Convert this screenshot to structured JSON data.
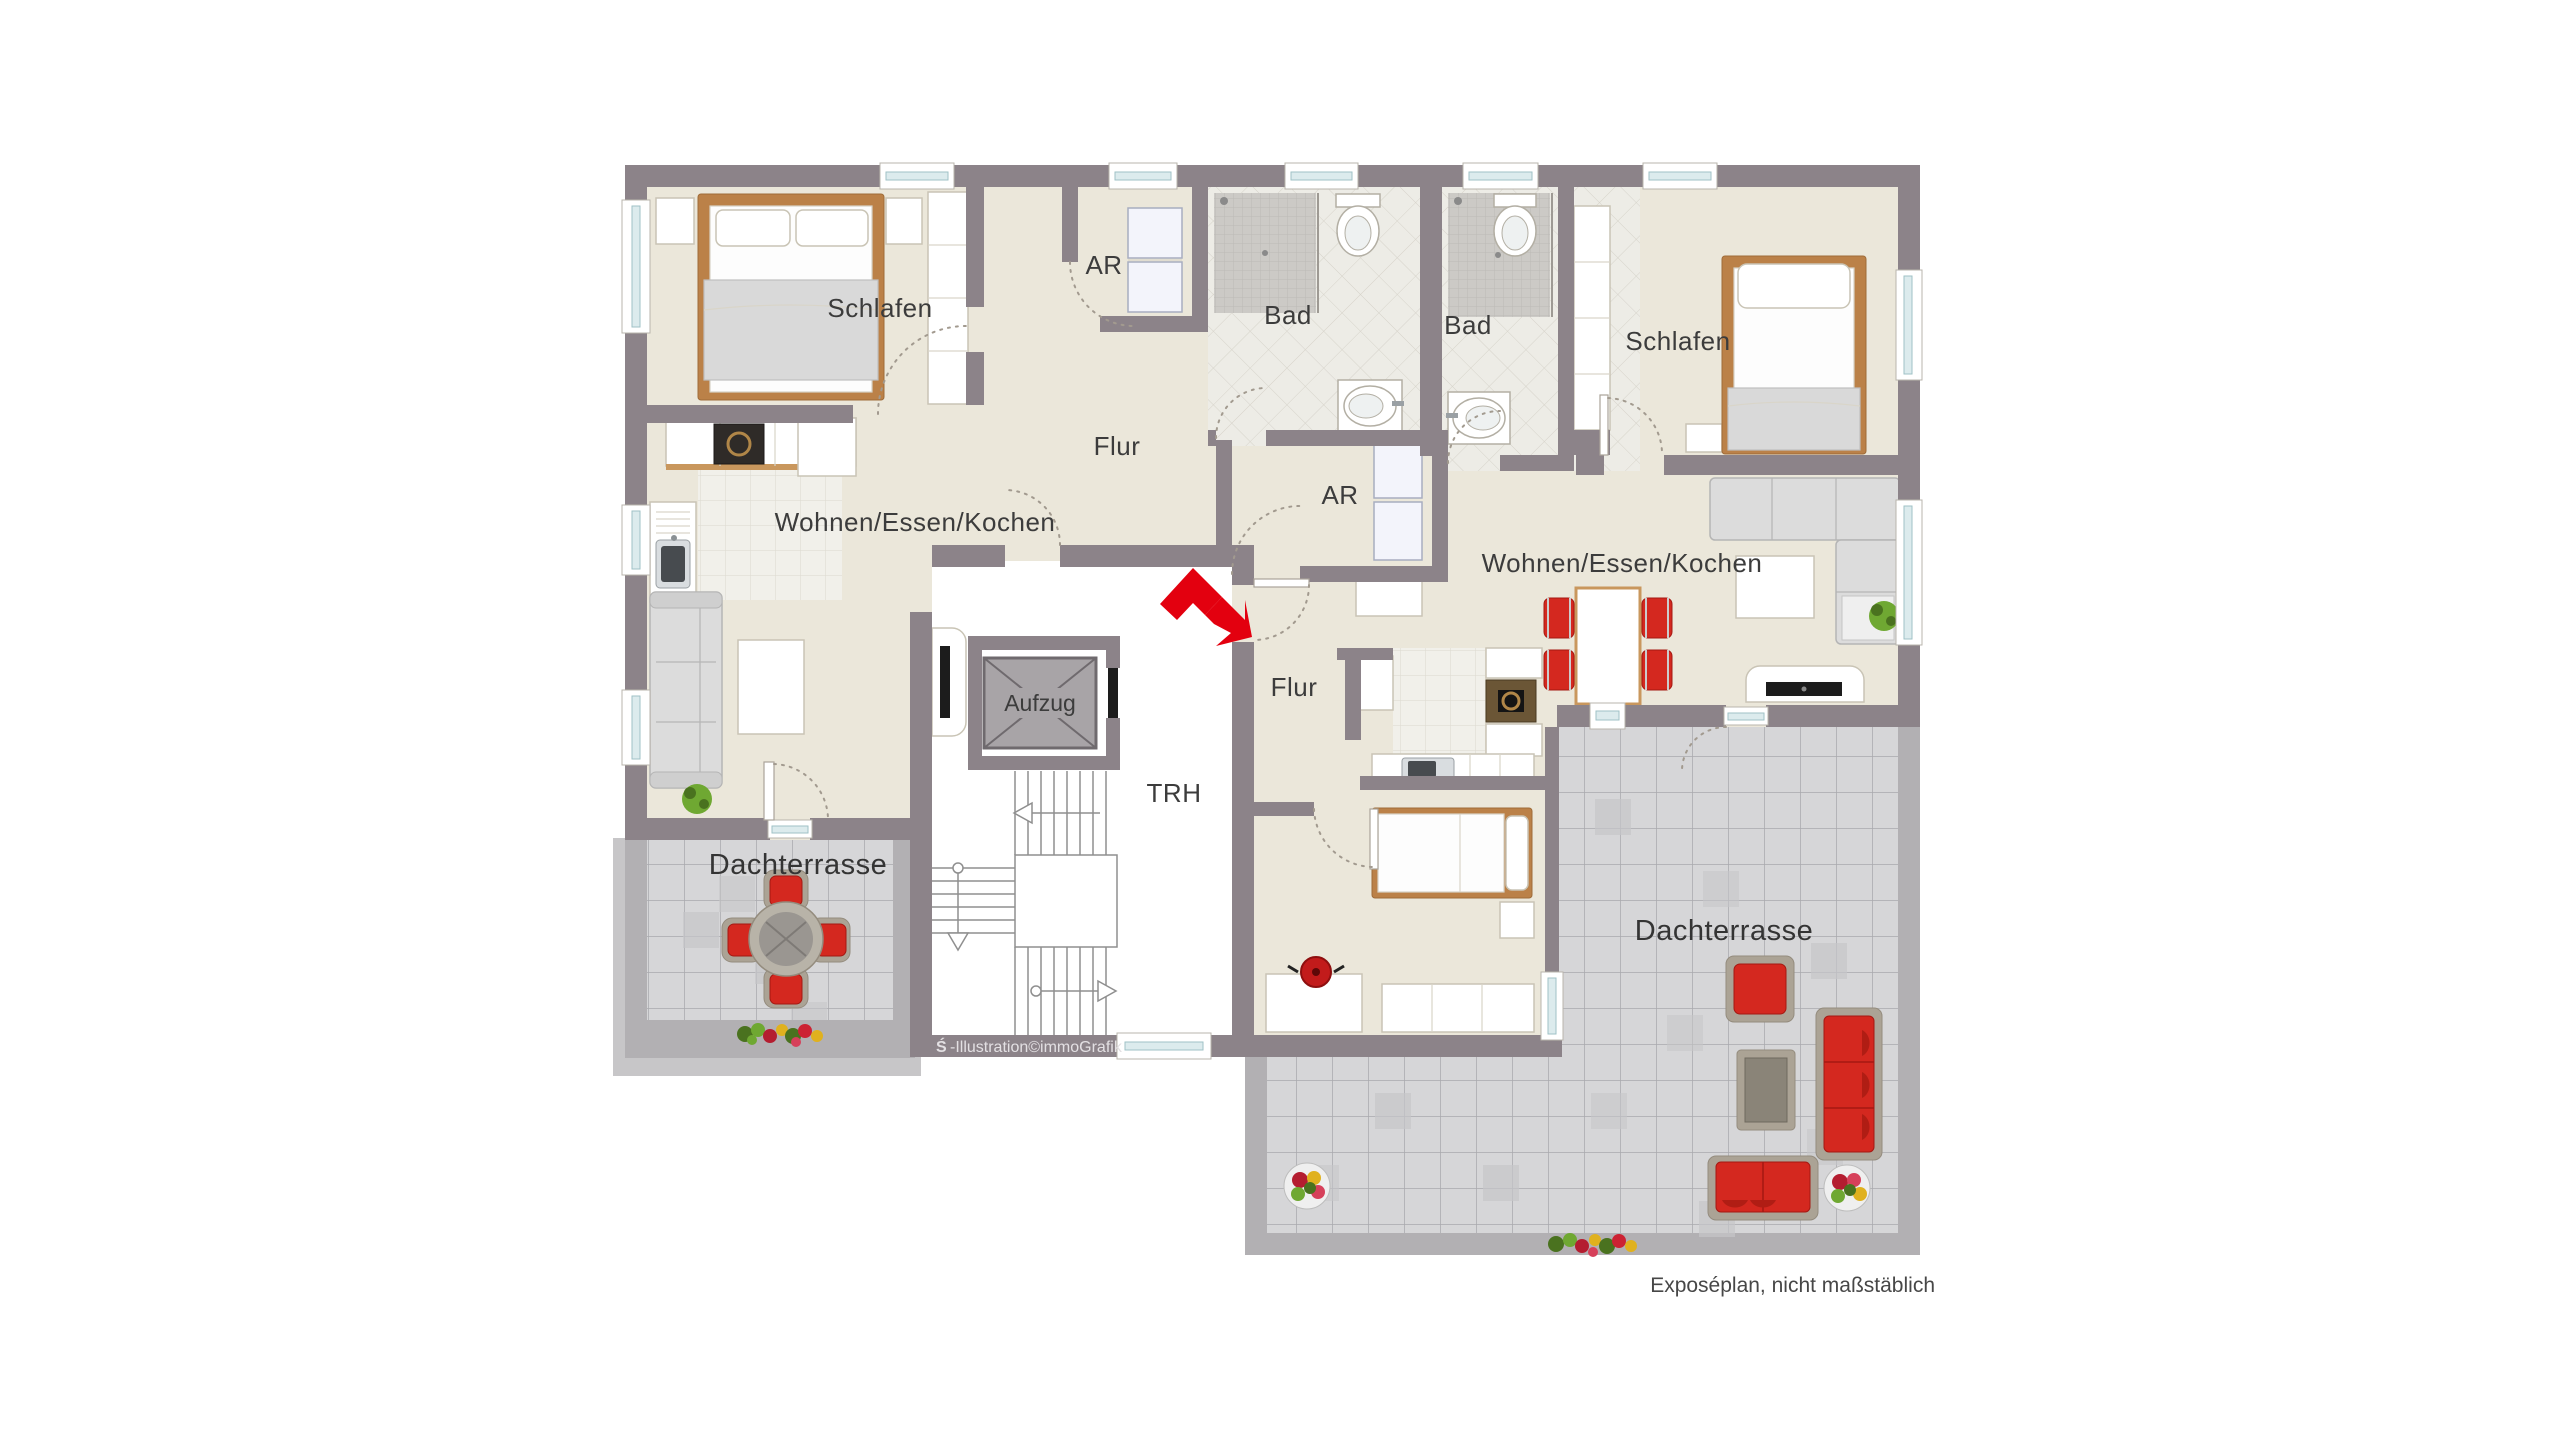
{
  "floorplan": {
    "rooms": {
      "schlafen_left": "Schlafen",
      "ar_left": "AR",
      "bad_left": "Bad",
      "bad_right": "Bad",
      "schlafen_right": "Schlafen",
      "flur_left": "Flur",
      "ar_right": "AR",
      "wohnen_left": "Wohnen/Essen/Kochen",
      "wohnen_right": "Wohnen/Essen/Kochen",
      "aufzug": "Aufzug",
      "trh": "TRH",
      "flur_right": "Flur",
      "dachterrasse_left": "Dachterrasse",
      "dachterrasse_right": "Dachterrasse"
    },
    "watermark": {
      "icon": "sparkasse-logo-icon",
      "icon_glyph": "Ś",
      "text": "-Illustration©immoGrafik"
    },
    "disclaimer": "Exposéplan, nicht maßstäblich",
    "logo_icon": "red-zigzag-arrow-icon",
    "colors": {
      "wall": "#8c8389",
      "floor": "#ebe7da",
      "terrace_band": "#b2b0b3",
      "terrace_tile": "#d6d6d8",
      "accent_red": "#d4281f",
      "logo_red": "#e3000f",
      "wood": "#bb8148",
      "window_glass": "#dcebed",
      "label_text": "#3c3c3c"
    }
  }
}
